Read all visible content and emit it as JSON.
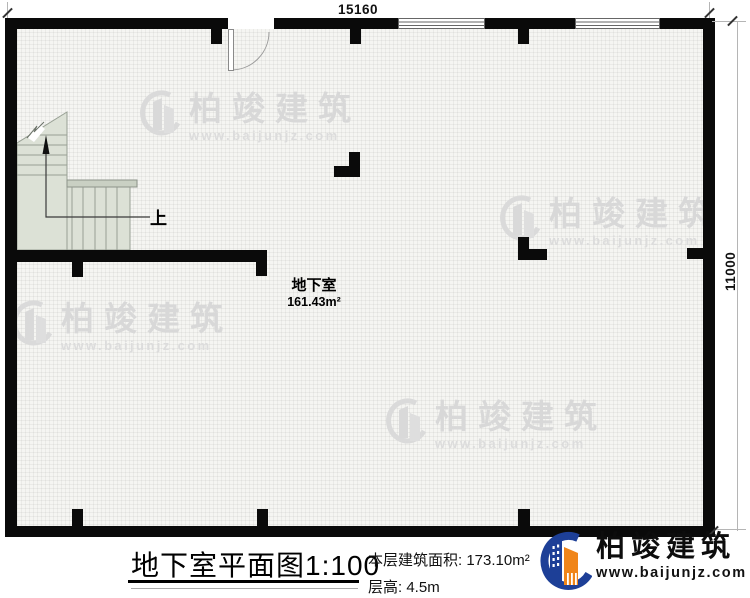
{
  "plan": {
    "dim_top": "15160",
    "dim_right": "11000",
    "room": {
      "name": "地下室",
      "area": "161.43m²"
    },
    "stair_up_label": "上"
  },
  "watermark": {
    "brand": "柏竣建筑",
    "url": "www.baijunjz.com"
  },
  "footer": {
    "title": "地下室平面图",
    "scale": "1:100",
    "area_label": "本层建筑面积:",
    "area_value": "173.10m²",
    "height_label": "层高:",
    "height_value": "4.5m",
    "logo": {
      "brand": "柏竣建筑",
      "url": "www.baijunjz.com"
    }
  },
  "icons": {
    "stair_direction": "up-arrow-icon",
    "door": "door-swing-arc-icon",
    "brand": "building-swoosh-logo-icon",
    "watermark": "building-swoosh-watermark-icon"
  },
  "colors": {
    "wall": "#0a0a0a",
    "stair_fill": "#dce1d6",
    "brand_blue": "#1d3f97",
    "brand_orange": "#f08519",
    "watermark_gray": "#d8d8d8"
  }
}
